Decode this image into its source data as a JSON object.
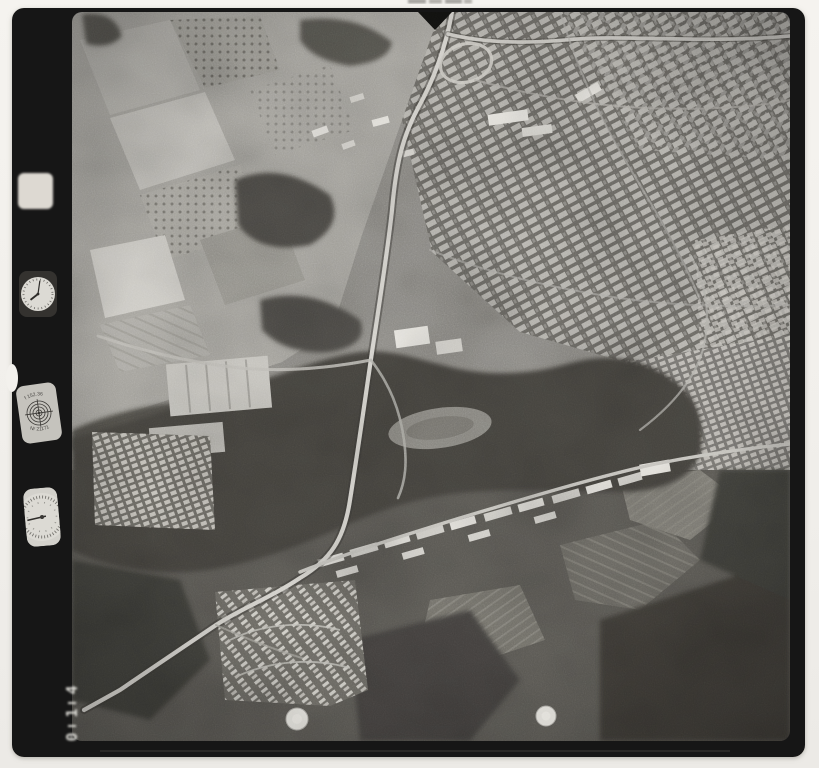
{
  "film_strip": {
    "frame_number": "014",
    "frame_digits": [
      "4",
      "1",
      "0"
    ],
    "calibration_plate": {
      "top_text": "f 152.36",
      "bottom_text": "Nr 21171"
    },
    "clock": {
      "hour_hand_transform": "rotate(232)",
      "minute_hand_transform": "rotate(8)"
    },
    "altimeter": {
      "needle_transform": "rotate(262)"
    }
  },
  "colors": {
    "paper": "#f3f1ed",
    "film": "#171614",
    "photo_base": "#8f8d88",
    "photo_light": "#d8d6d0",
    "photo_dark": "#44423e",
    "instrument_face": "#d9d7d1"
  }
}
